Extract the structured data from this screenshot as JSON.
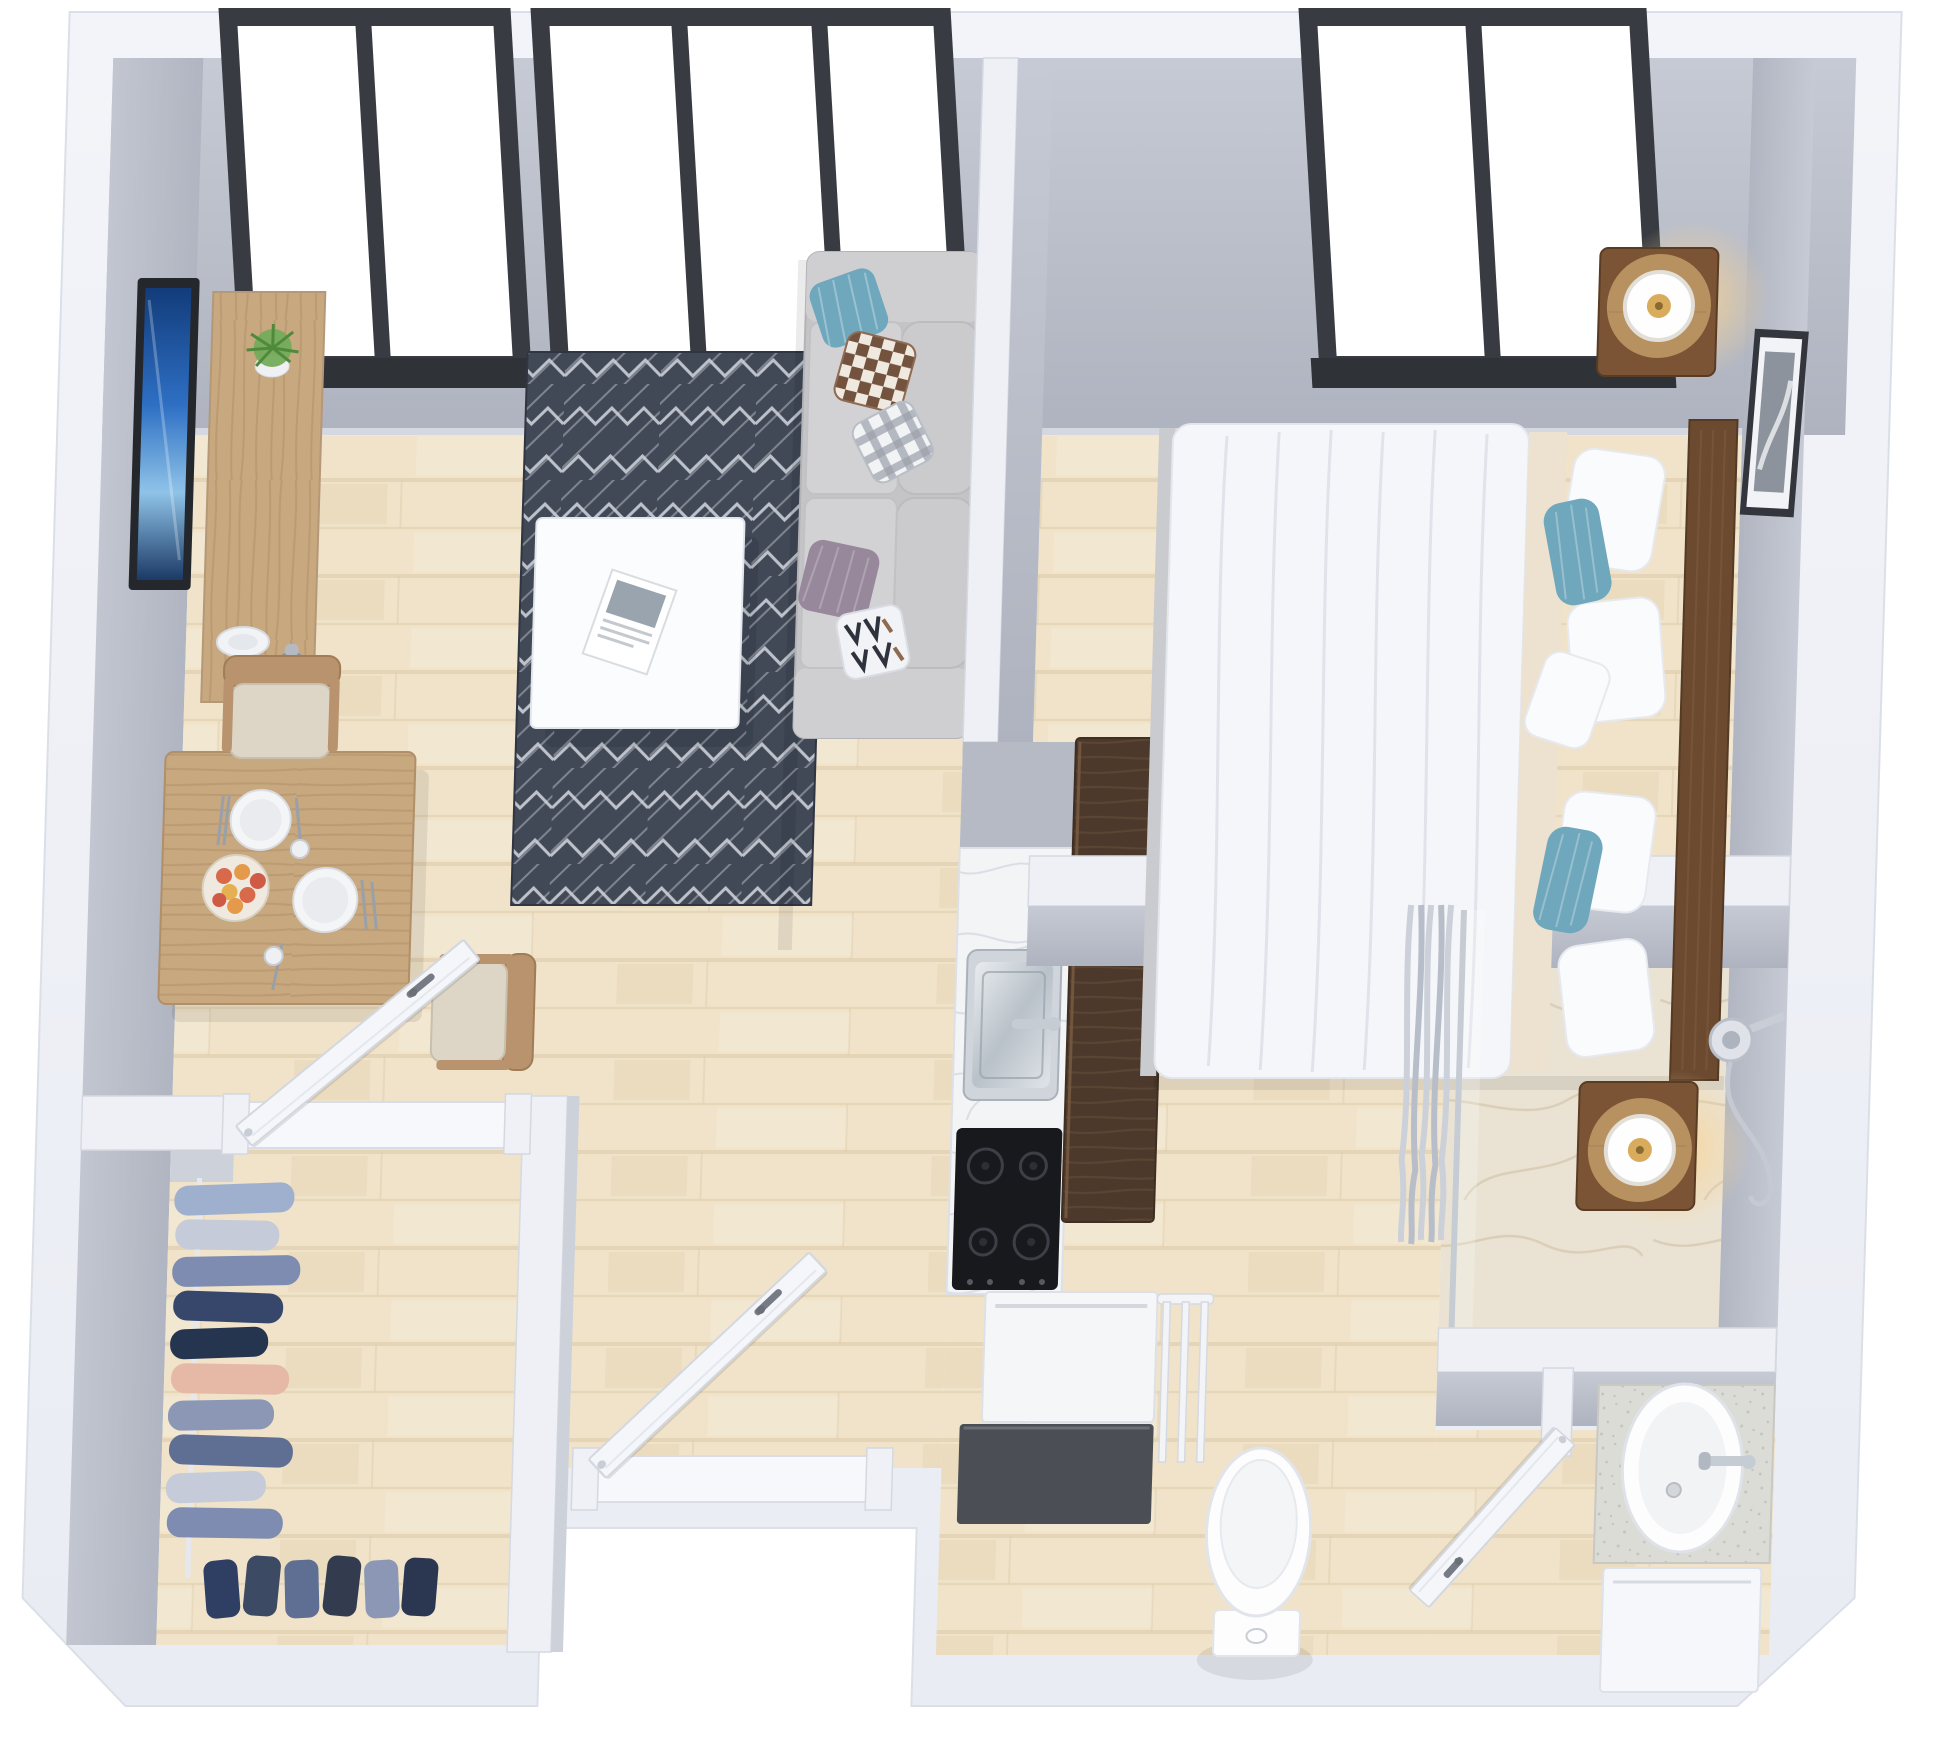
{
  "scene": {
    "type": "3d-floor-plan-render",
    "view": "top-down isometric",
    "description": "Photorealistic top-down 3D rendering of a studio apartment floor plan with living room, dining nook, bedroom, kitchen, walk-in closet and bathroom"
  },
  "rooms": [
    {
      "id": "living-room",
      "items": [
        "wall-tv",
        "media-console",
        "potted-plant",
        "decor-plate",
        "vase",
        "geometric-area-rug",
        "white-coffee-table",
        "open-magazine",
        "sofa",
        "knit-pillow",
        "checkered-pillow",
        "gingham-pillow",
        "mauve-pillow",
        "geometric-pillow"
      ]
    },
    {
      "id": "dining-area",
      "items": [
        "square-dining-table",
        "upholstered-chair-north",
        "upholstered-chair-east",
        "dinner-plates",
        "fruit-bowl",
        "apples",
        "cutlery",
        "drinking-glasses"
      ]
    },
    {
      "id": "bedroom",
      "items": [
        "double-bed",
        "white-duvet",
        "beige-sheet",
        "white-pillows",
        "teal-accent-pillows",
        "wood-headboard",
        "nightstand-top",
        "nightstand-bottom",
        "table-lamp-top",
        "table-lamp-bottom",
        "wall-art"
      ]
    },
    {
      "id": "kitchen",
      "items": [
        "walnut-bar-counter",
        "marble-countertop",
        "stainless-sink",
        "faucet",
        "induction-cooktop",
        "white-appliance-front",
        "dark-base-cabinet",
        "white-rail"
      ]
    },
    {
      "id": "walk-in-closet",
      "items": [
        "clothes-rail",
        "hanging-garments",
        "folded-garments"
      ]
    },
    {
      "id": "bathroom",
      "items": [
        "walk-in-shower",
        "marble-shower-floor",
        "shower-curtain",
        "glass-partition-pole",
        "hand-shower",
        "vanity-countertop",
        "oval-sink",
        "sink-faucet",
        "vanity-cabinet",
        "toilet"
      ]
    },
    {
      "id": "hallway",
      "items": [
        "closet-door",
        "entry-door",
        "bedroom-door",
        "bathroom-door"
      ]
    }
  ],
  "windows": [
    {
      "id": "living-room-window-left",
      "panes": 2
    },
    {
      "id": "living-room-window-right",
      "panes": 2
    },
    {
      "id": "bedroom-window",
      "panes": 2
    }
  ],
  "colors": {
    "wall_white": "#eef0f5",
    "wall_face": "#b8bdc8",
    "window_frame": "#383c42",
    "floor_wood": "#f0e3c9",
    "floor_line": "#e0cfae",
    "marble": "#eae3d4",
    "marble_vein": "#d6c9b0",
    "rug": "#414856",
    "rug_line": "#ccd1d9",
    "sofa": "#c4c4c7",
    "cushion": "#d2d2d5",
    "wood": "#c8a87f",
    "walnut": "#4d392b",
    "duvet": "#f5f6f9",
    "sheet": "#ece2cf",
    "teal": "#6fa7bc",
    "nightstand": "#7b5435",
    "lamp_glow": "#f6cd8c",
    "chrome": "#c6ccd4",
    "cooktop": "#17191d",
    "tv_screen": "#2e6fc4",
    "porcelain": "#fbfcfe",
    "speckle": "#dcdcd7",
    "door": "#f4f6f9"
  }
}
